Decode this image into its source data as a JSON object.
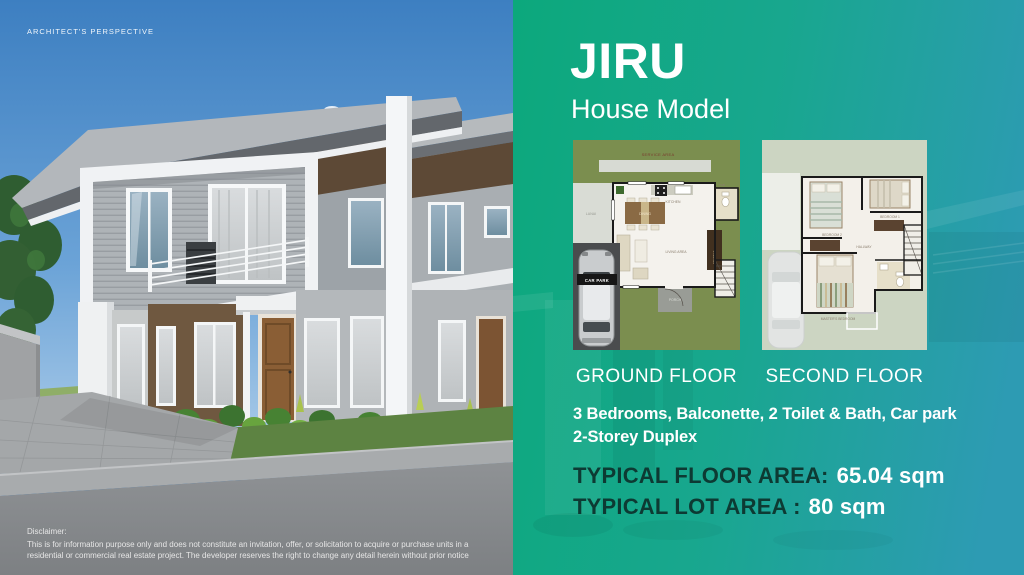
{
  "watermark": "ARCHITECT'S PERSPECTIVE",
  "panel": {
    "title": "JIRU",
    "subtitle": "House Model",
    "ground_floor_label": "GROUND FLOOR",
    "second_floor_label": "SECOND FLOOR",
    "features_line1": "3 Bedrooms, Balconette, 2 Toilet & Bath, Car park",
    "features_line2": "2-Storey Duplex",
    "floor_area_label": "TYPICAL FLOOR AREA:",
    "floor_area_value": "65.04 sqm",
    "lot_area_label": "TYPICAL LOT AREA :",
    "lot_area_value": "80 sqm",
    "accent_green": "#0ca87c",
    "accent_teal": "#2d9bb3",
    "area_label_color": "#0d3a33"
  },
  "ground_floor_plan": {
    "service_area_label": "SERVICE AREA",
    "lanai_label": "LANAI",
    "kitchen_label": "KITCHEN",
    "tb_label": "T&B",
    "dining_label": "DINING",
    "living_area_label": "LIVING AREA",
    "storage_label": "STORAGE",
    "porch_label": "PORCH",
    "car_park_label": "CAR PARK"
  },
  "second_floor_plan": {
    "bedroom2_label": "BEDROOM 2",
    "bedroom1_label": "BEDROOM 1",
    "hallway_label": "HALLWAY",
    "masters_bedroom_label": "MASTER'S BEDROOM"
  },
  "disclaimer": {
    "heading": "Disclaimer:",
    "body": "This is for information purpose only and does not constitute an invitation, offer, or solicitation to acquire or purchase units in a residential or commercial real estate project. The developer reserves the right to change any detail herein without prior notice"
  }
}
